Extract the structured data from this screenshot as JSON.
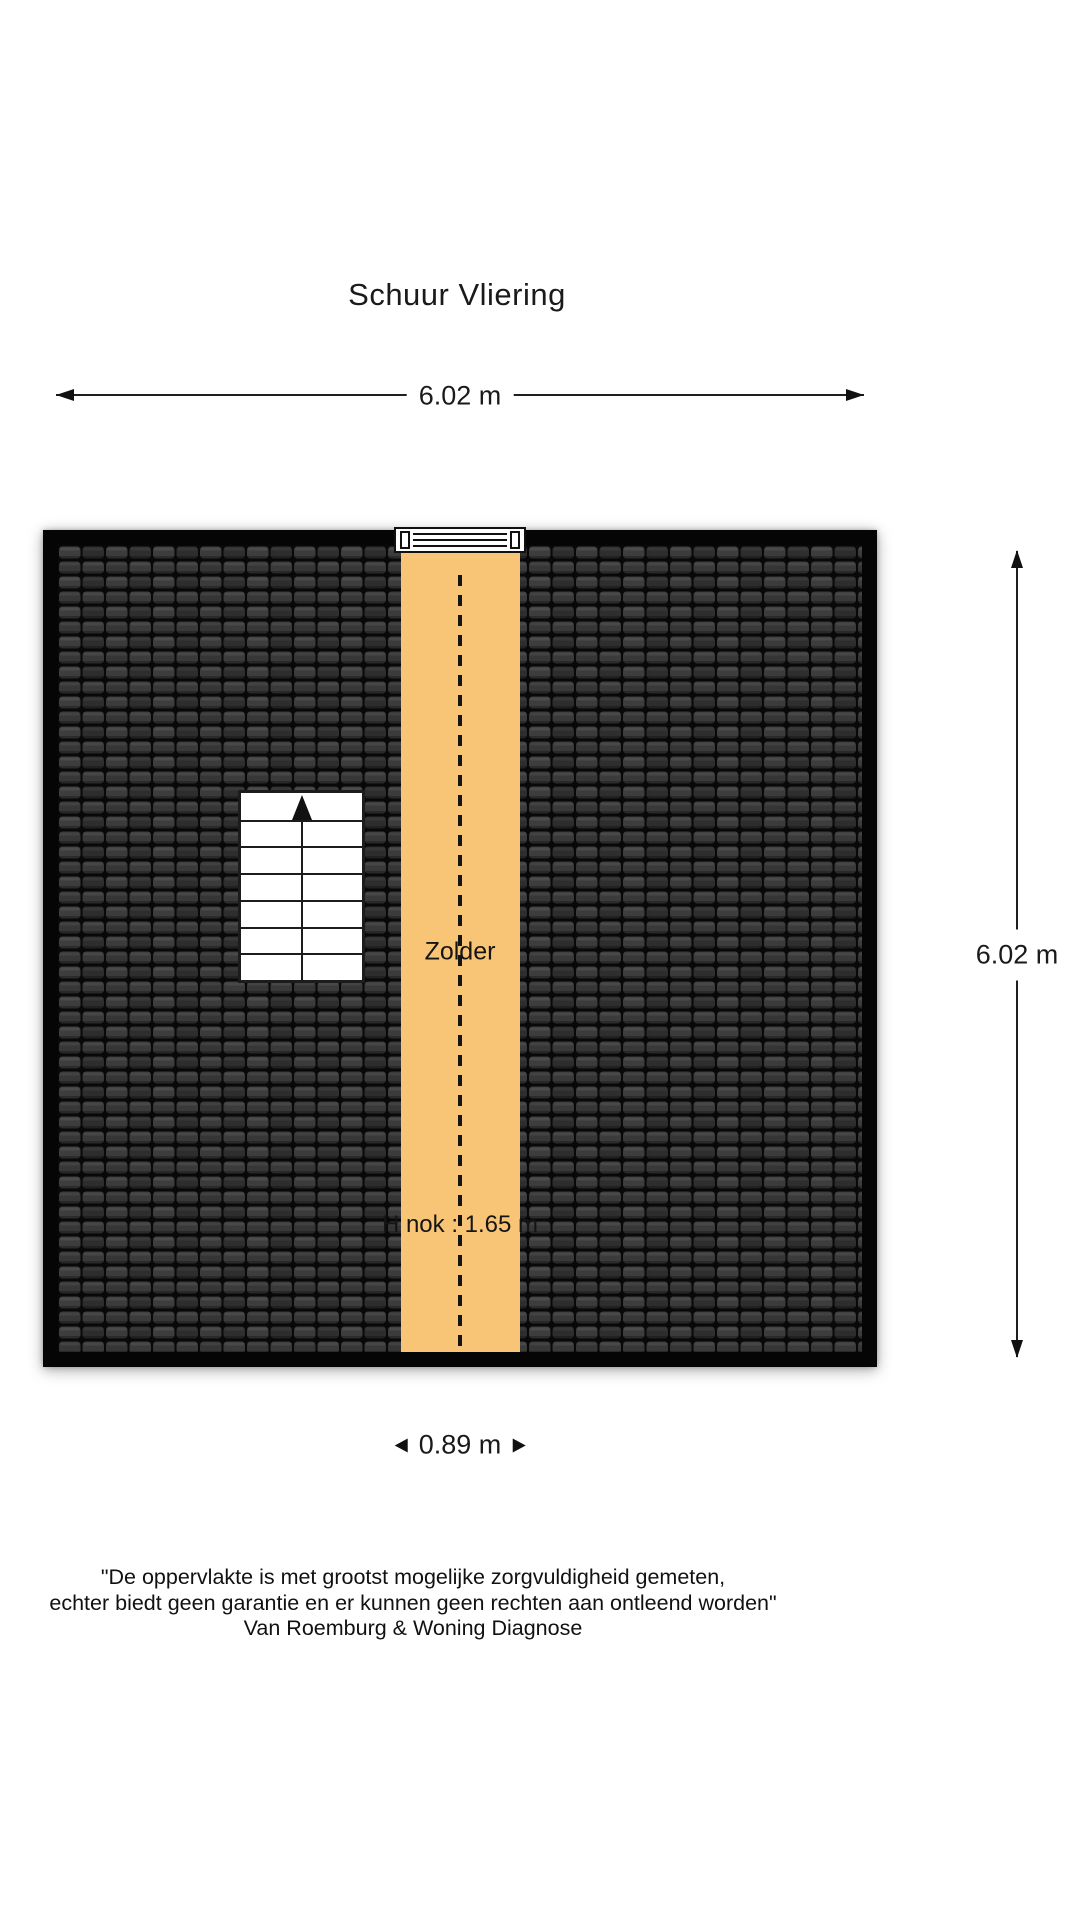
{
  "title": "Schuur Vliering",
  "dimensions": {
    "top": {
      "label": "6.02 m"
    },
    "right": {
      "label": "6.02 m"
    },
    "bottom": {
      "label": "0.89 m"
    }
  },
  "plan": {
    "room_label": "Zolder",
    "ridge_height_label": "H nok : 1.65 m",
    "colors": {
      "wall": "#050505",
      "roof_tile": "#353535",
      "roof_tile_gap": "#080808",
      "attic_strip_orange": "#F8C475",
      "ridge_dash": "#151515"
    },
    "features": [
      "roof-tiles",
      "attic-strip",
      "ridge-dashed-line",
      "staircase",
      "roof-hatch"
    ]
  },
  "disclaimer": {
    "line1": "\"De oppervlakte is met grootst mogelijke zorgvuldigheid gemeten,",
    "line2": "echter biedt geen garantie en er kunnen geen rechten aan ontleend worden\"",
    "line3": "Van Roemburg & Woning Diagnose"
  }
}
